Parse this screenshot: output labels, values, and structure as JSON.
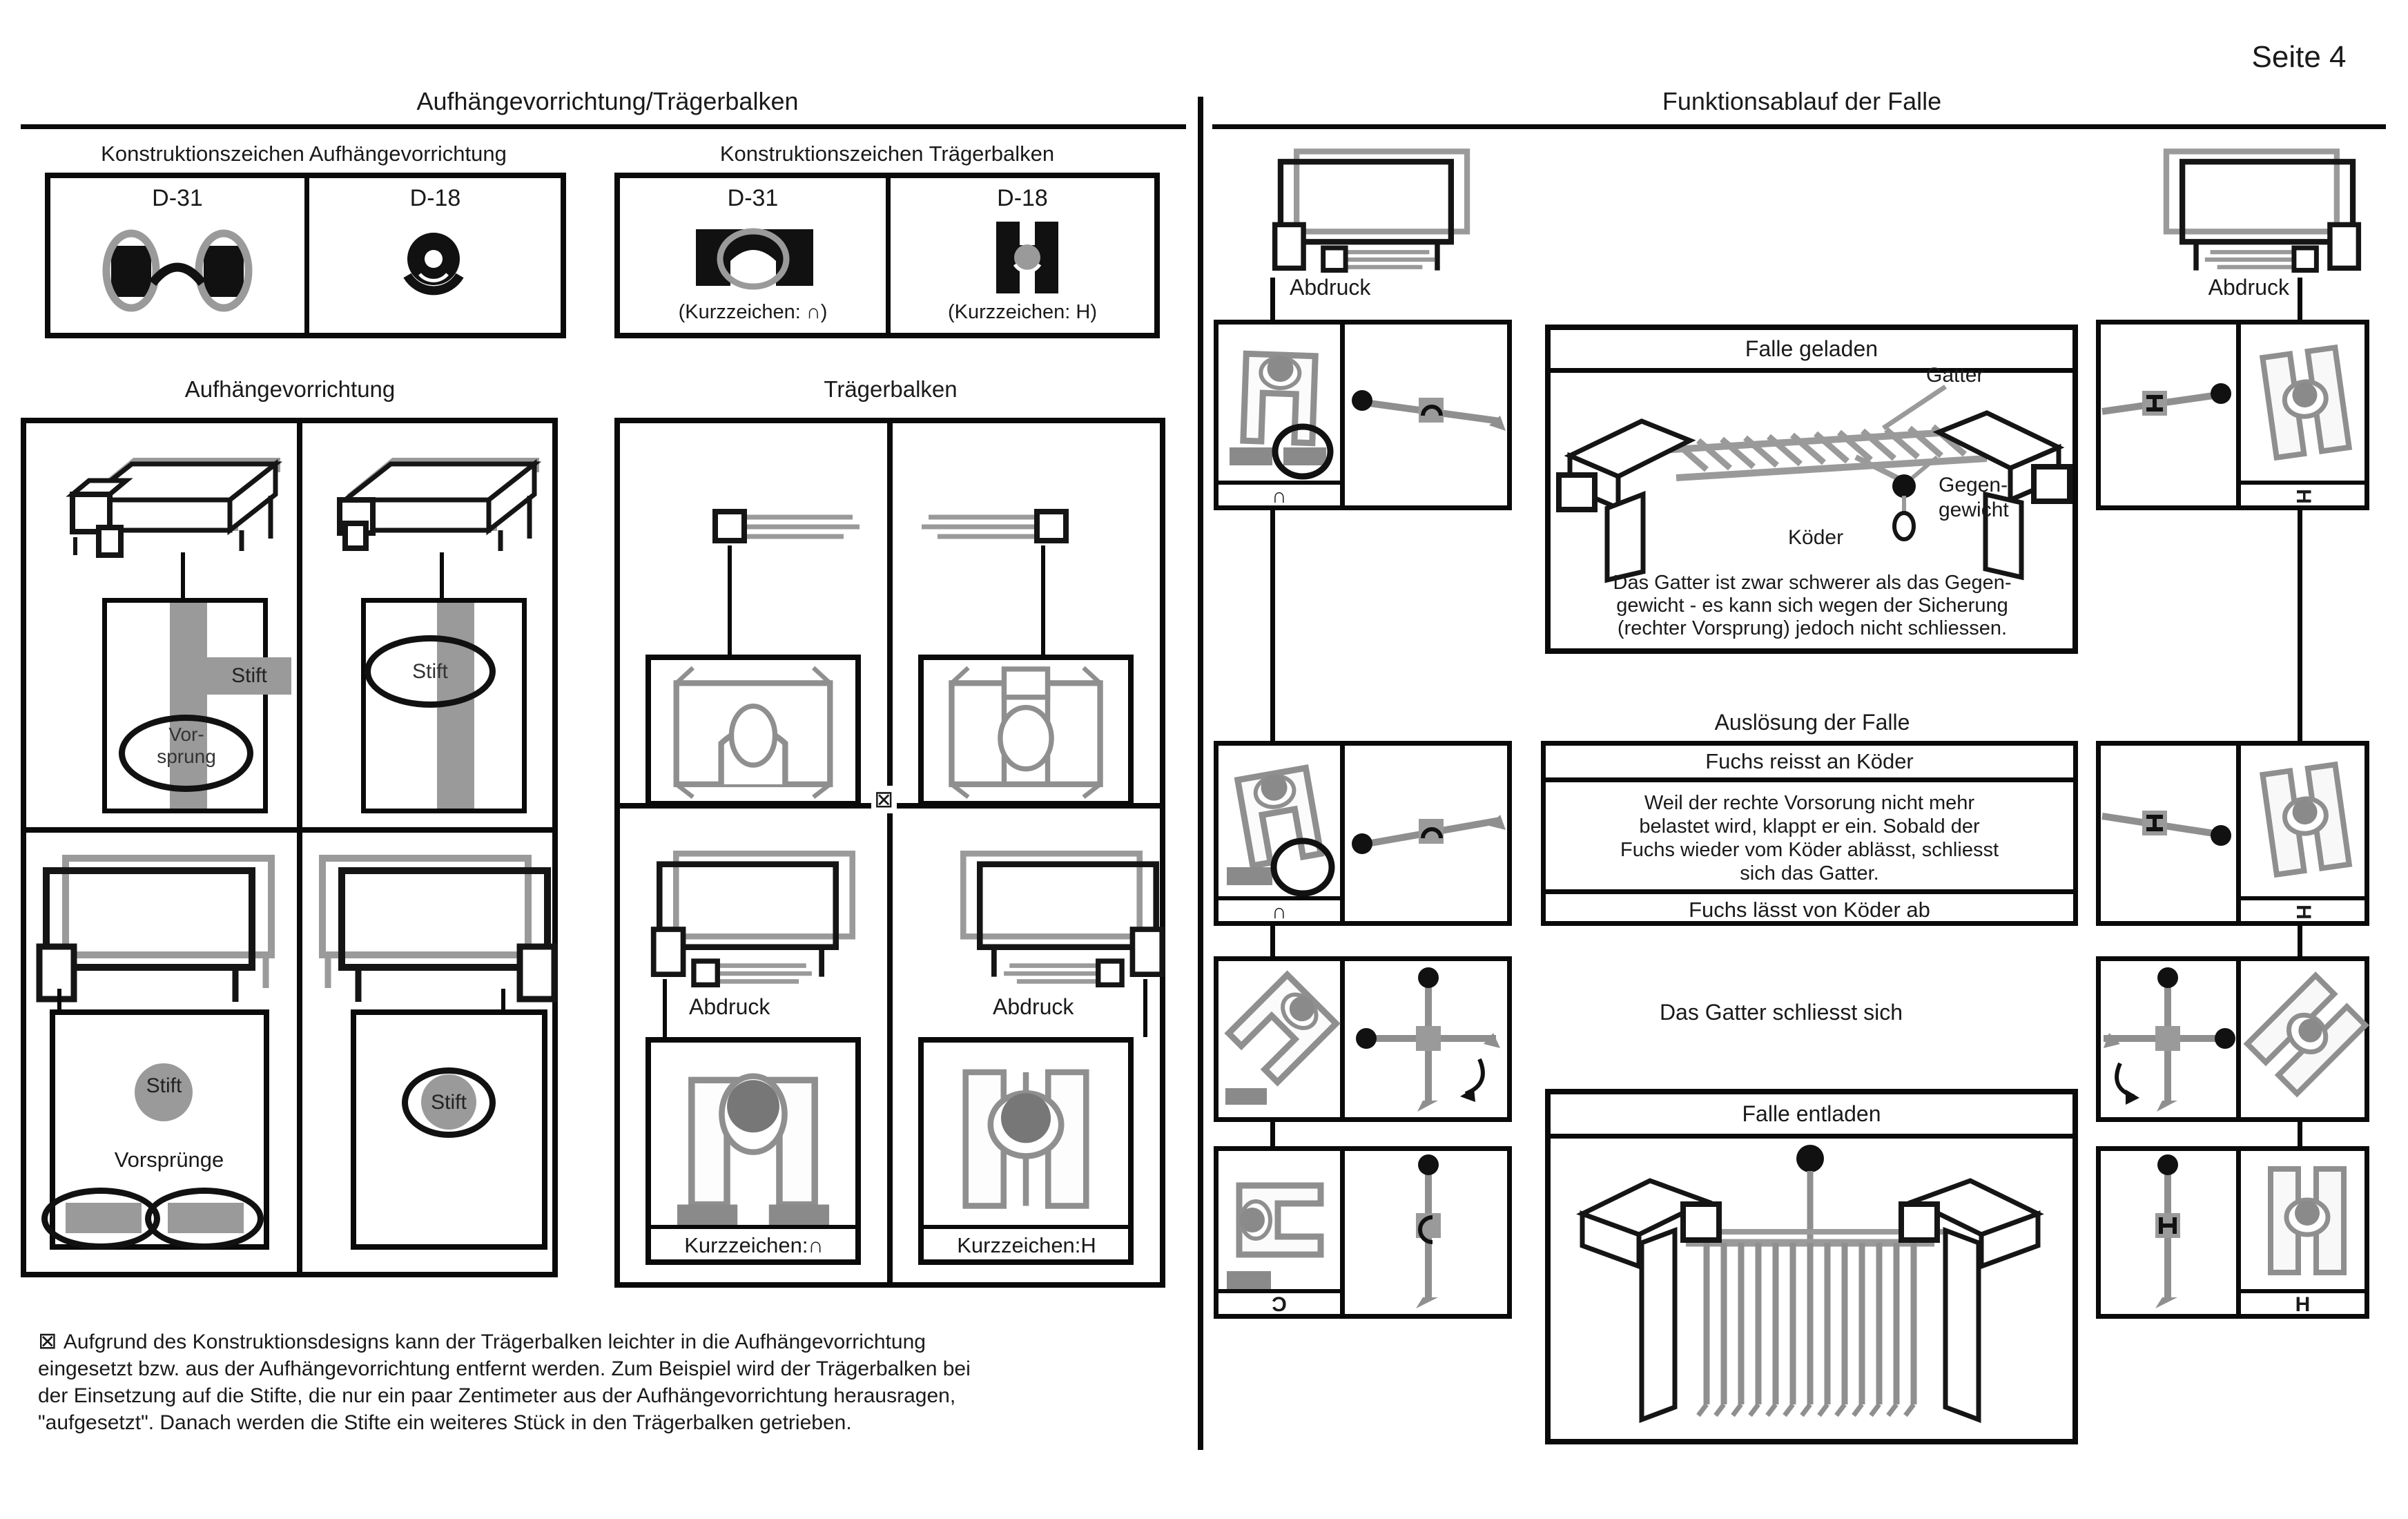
{
  "page": {
    "number_label": "Seite 4"
  },
  "left": {
    "title": "Aufhängevorrichtung/Trägerbalken",
    "kz_tables": {
      "aufhaengevorrichtung": {
        "title": "Konstruktionszeichen Aufhängevorrichtung",
        "col1": "D-31",
        "col2": "D-18"
      },
      "traegerbalken": {
        "title": "Konstruktionszeichen Trägerbalken",
        "col1": "D-31",
        "col2": "D-18",
        "kurzzeichen1": "(Kurzzeichen: ∩)",
        "kurzzeichen2": "(Kurzzeichen: H)"
      }
    },
    "aufhaengevorrichtung": {
      "title": "Aufhängevorrichtung",
      "stift": "Stift",
      "vorsprung_line1": "Vor-",
      "vorsprung_line2": "sprung",
      "vorspruenge": "Vorsprünge"
    },
    "traegerbalken": {
      "title": "Trägerbalken",
      "abdruck": "Abdruck",
      "kurzzeichen_cap": "Kurzzeichen:∩",
      "kurzzeichen_h": "Kurzzeichen:H",
      "footnote_marker": "⊠"
    },
    "footnote": {
      "marker": "⊠",
      "lines": [
        "Aufgrund des Konstruktionsdesigns kann der Trägerbalken leichter in die Aufhängevorrichtung",
        "eingesetzt bzw. aus der Aufhängevorrichtung entfernt werden. Zum Beispiel wird der Trägerbalken bei",
        "der Einsetzung auf die Stifte, die nur ein paar Zentimeter aus der Aufhängevorrichtung herausragen,",
        "\"aufgesetzt\". Danach werden die Stifte ein weiteres Stück in den Trägerbalken getrieben."
      ]
    }
  },
  "right": {
    "title": "Funktionsablauf der Falle",
    "abdruck_left": "Abdruck",
    "abdruck_right": "Abdruck",
    "falle_geladen": {
      "title": "Falle geladen",
      "gatter": "Gatter",
      "gegengewicht_line1": "Gegen-",
      "gegengewicht_line2": "gewicht",
      "koeder": "Köder",
      "text_lines": [
        "Das Gatter ist zwar schwerer als das Gegen-",
        "gewicht - es kann sich wegen der Sicherung",
        "(rechter Vorsprung) jedoch nicht schliessen."
      ]
    },
    "ausloesung": {
      "title": "Auslösung der Falle",
      "header": "Fuchs reisst an Köder",
      "text_lines": [
        "Weil der rechte Vorsorung nicht mehr",
        "belastet wird, klappt er ein. Sobald der",
        "Fuchs wieder vom Köder ablässt, schliesst",
        "sich das Gatter."
      ],
      "footer": "Fuchs lässt von Köder ab"
    },
    "gatter_schliesst": "Das Gatter schliesst sich",
    "falle_entladen": {
      "title": "Falle entladen"
    },
    "symbols": {
      "cap": "∩",
      "cap_mirrored": "Ɔ",
      "h": "H"
    }
  }
}
